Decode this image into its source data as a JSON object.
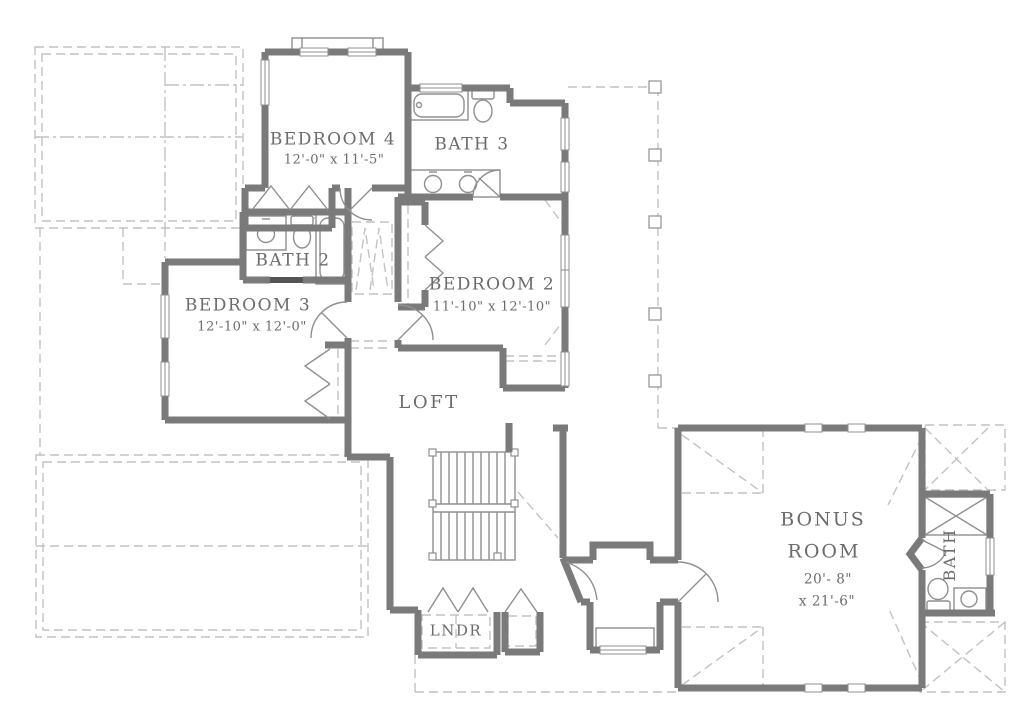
{
  "rooms": {
    "bedroom4": {
      "name": "BEDROOM 4",
      "dims": "12'-0\" x 11'-5\""
    },
    "bath3": {
      "name": "BATH 3"
    },
    "bath2": {
      "name": "BATH 2"
    },
    "bedroom3": {
      "name": "BEDROOM 3",
      "dims": "12'-10\" x 12'-0\""
    },
    "bedroom2": {
      "name": "BEDROOM 2",
      "dims": "11'-10\" x 12'-10\""
    },
    "loft": {
      "name": "LOFT"
    },
    "laundry": {
      "name": "LNDR"
    },
    "bonus_room": {
      "name_line1": "BONUS",
      "name_line2": "ROOM",
      "dims_line1": "20'- 8\"",
      "dims_line2": "x 21'-6\""
    },
    "bonus_bath": {
      "name": "BATH"
    }
  },
  "colors": {
    "wall": "#7a7a7a",
    "thin_line": "#8f8f8f",
    "dashed_line": "#c2c2c2",
    "text": "#6b6b6b",
    "pocket_door": "#555555",
    "background": "#ffffff"
  }
}
